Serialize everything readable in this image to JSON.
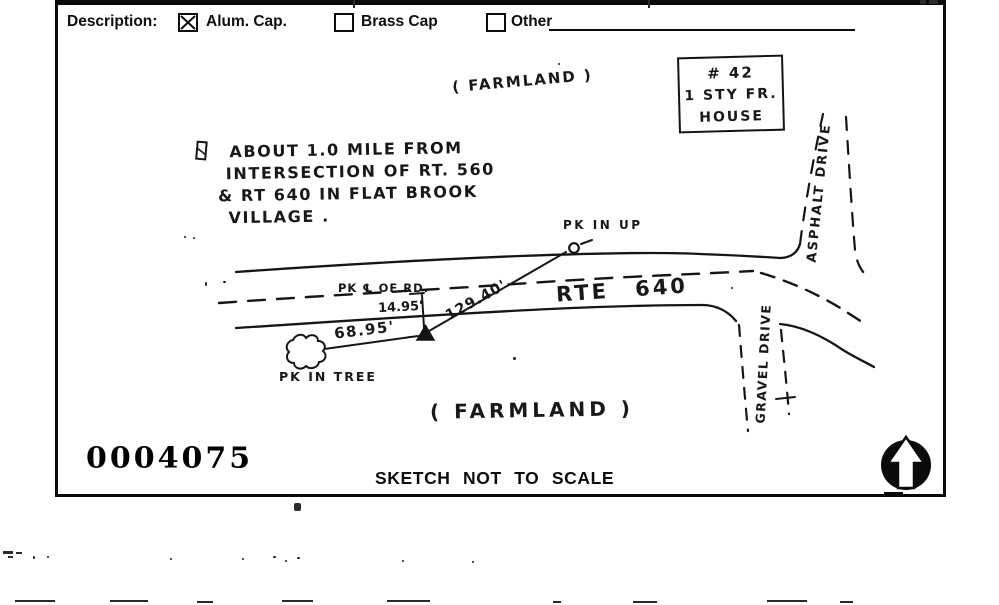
{
  "form": {
    "description_label": "Description:",
    "options": [
      {
        "label": "Alum. Cap.",
        "checked": true
      },
      {
        "label": "Brass Cap",
        "checked": false
      },
      {
        "label": "Other",
        "checked": false
      }
    ]
  },
  "sketch": {
    "farmland_top": "( FARMLAND )",
    "farmland_bottom": "( FARMLAND )",
    "note": {
      "lines": [
        "ABOUT 1.0 MILE FROM",
        "INTERSECTION OF RT. 560",
        "& RT 640 IN FLAT BROOK",
        "VILLAGE ."
      ]
    },
    "house": {
      "lines": [
        "# 42",
        "1 STY FR.",
        "HOUSE"
      ]
    },
    "labels": {
      "pk_in_up": "PK IN UP",
      "pk_cl_of_rd": "PK ℄ OF RD.",
      "pk_in_tree": "PK IN TREE",
      "route": "RTE 640",
      "asphalt_drive": "ASPHALT DRIVE",
      "gravel_drive": "GRAVEL DRIVE"
    },
    "measurements": {
      "offset_from_centerline": "14.95'",
      "distance_to_tree": "68.95'",
      "distance_to_pole": "129.40'"
    }
  },
  "footer": {
    "stamp_number": "0004075",
    "scale_note": "SKETCH NOT TO SCALE"
  }
}
